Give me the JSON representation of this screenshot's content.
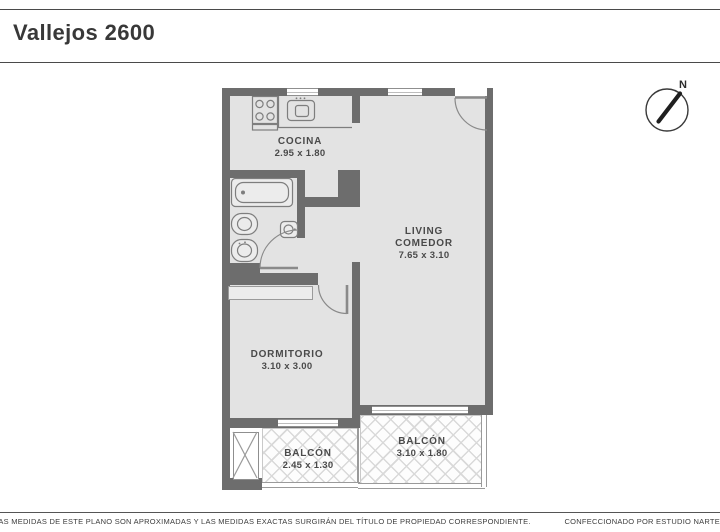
{
  "header": {
    "title": "Vallejos 2600"
  },
  "compass": {
    "label": "N"
  },
  "rooms": [
    {
      "id": "cocina",
      "name": "COCINA",
      "dims": "2.95 x 1.80"
    },
    {
      "id": "living",
      "name": "LIVING",
      "name2": "COMEDOR",
      "dims": "7.65 x 3.10"
    },
    {
      "id": "dormitorio",
      "name": "DORMITORIO",
      "dims": "3.10 x 3.00"
    },
    {
      "id": "balcon-left",
      "name": "BALCÓN",
      "dims": "2.45 x 1.30"
    },
    {
      "id": "balcon-right",
      "name": "BALCÓN",
      "dims": "3.10 x 1.80"
    }
  ],
  "footer": {
    "left": "LAS MEDIDAS  DE ESTE PLANO SON APROXIMADAS Y LAS MEDIDAS EXACTAS SURGIRÁN DEL TÍTULO DE PROPIEDAD CORRESPONDIENTE.",
    "right": "CONFECCIONADO POR ESTUDIO NARTE"
  },
  "colors": {
    "wall": "#6d6d6d",
    "floor": "#e3e3e3",
    "hatch_line": "#d9d9d9",
    "fixture_stroke": "#7e7e7e"
  }
}
